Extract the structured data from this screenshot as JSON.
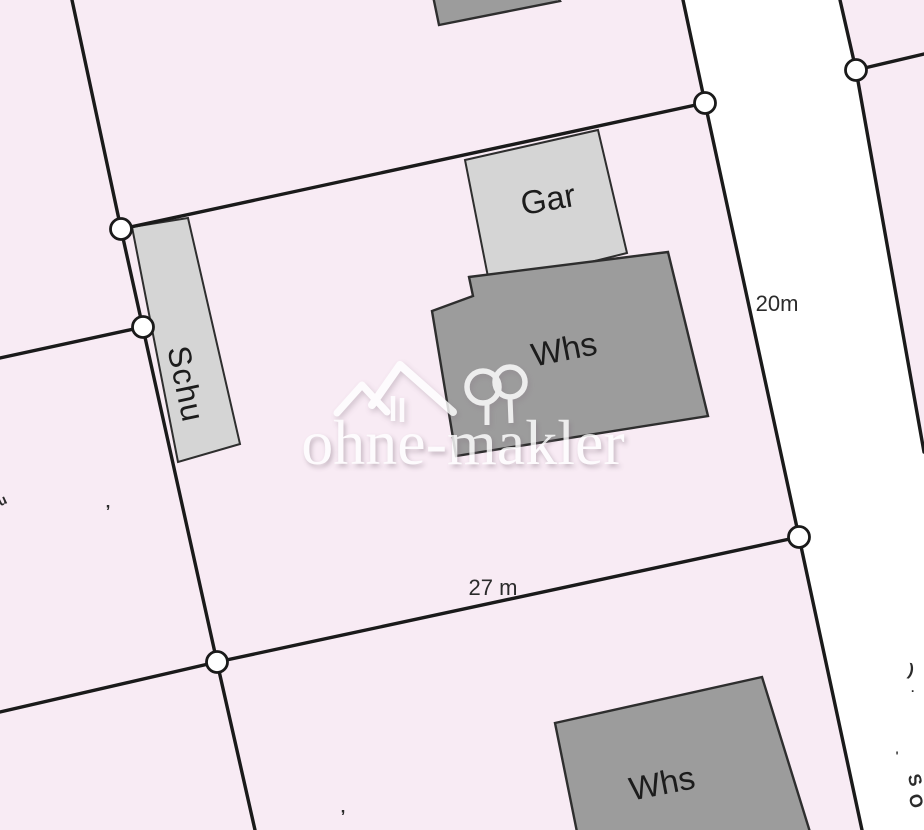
{
  "colors": {
    "background": "#f8ebf4",
    "road": "#ffffff",
    "boundary": "#1a1a1a",
    "building_light": "#d5d5d5",
    "building_dark": "#9c9c9c",
    "building_outline": "#2e2e2e",
    "label": "#1c1c1c",
    "dimension": "#2b2b2b",
    "watermark": "#ffffff"
  },
  "plan": {
    "buildings": [
      {
        "id": "north-partial",
        "label": ""
      },
      {
        "id": "gar",
        "label": "Gar"
      },
      {
        "id": "whs-main",
        "label": "Whs"
      },
      {
        "id": "schu",
        "label": "Schu"
      },
      {
        "id": "whs-south",
        "label": "Whs"
      }
    ],
    "dimensions": [
      {
        "label": "20m"
      },
      {
        "label": "27 m"
      }
    ],
    "edge_fragments": [
      {
        "text": "u"
      },
      {
        "text": ","
      },
      {
        "text": ","
      },
      {
        "text": ")"
      },
      {
        "text": "·"
      },
      {
        "text": "'"
      },
      {
        "text": "S"
      },
      {
        "text": "O"
      }
    ]
  },
  "watermark": {
    "text": "ohne-makler"
  }
}
